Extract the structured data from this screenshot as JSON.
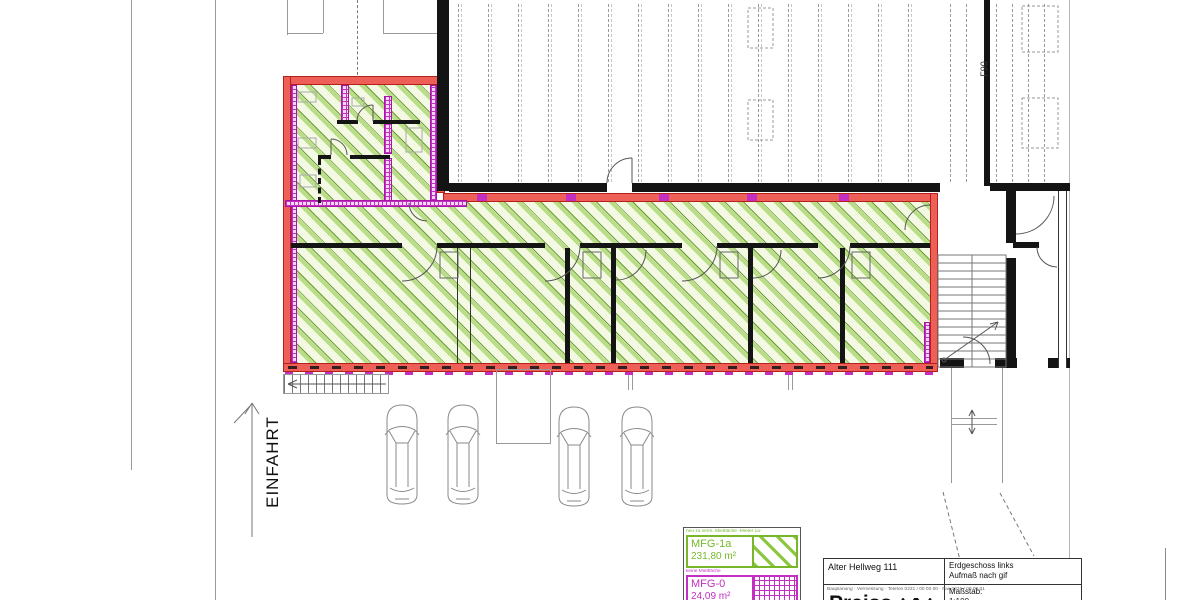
{
  "site": {
    "einfahrt_label": "EINFAHRT",
    "f90_label": "F90"
  },
  "legend": {
    "green_note": "neu zu verm. Mietfläche -Mieter 1a-",
    "green_code": "MFG-1a",
    "green_area": "231,80 m²",
    "magenta_note": "keine Mietfläche",
    "magenta_code": "MFG-0",
    "magenta_area": "24,09 m²",
    "green_color": "#76b82a",
    "magenta_color": "#c32ec3"
  },
  "title_block": {
    "project": "Alter Hellweg 111",
    "sheet_title_line1": "Erdgeschoss links",
    "sheet_title_line2": "Aufmaß nach gif",
    "address_line": "Bauplanung · Vermessung · Telefon 0231 / 00 00 00 · Fax 0231 / 00 00 01",
    "logo_text": "Preiss",
    "scale_label": "Maßstab:",
    "scale_value": "1:100"
  },
  "colors": {
    "highlight_red": "#ee5f58",
    "hatch_green": "#8cc63e",
    "wall_magenta": "#c32ec3",
    "wall_black": "#141414"
  }
}
